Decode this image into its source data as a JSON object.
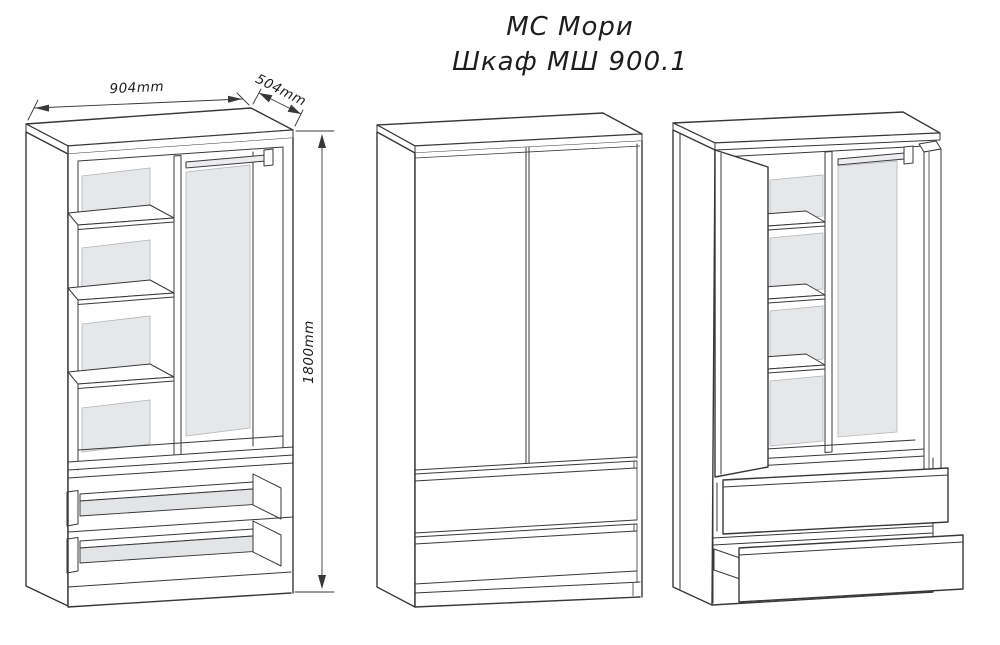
{
  "title": {
    "line1": "МС Мори",
    "line2": "Шкаф МШ 900.1"
  },
  "dimensions": {
    "width": "904mm",
    "depth": "504mm",
    "height": "1800mm"
  },
  "colors": {
    "line": "#38383a",
    "back_panel_gray": "#e6e7e9",
    "drawer_bottom_gray": "#e3e4e6",
    "rod_gray": "#ededef",
    "text": "#1d1d1f",
    "background": "#ffffff"
  }
}
